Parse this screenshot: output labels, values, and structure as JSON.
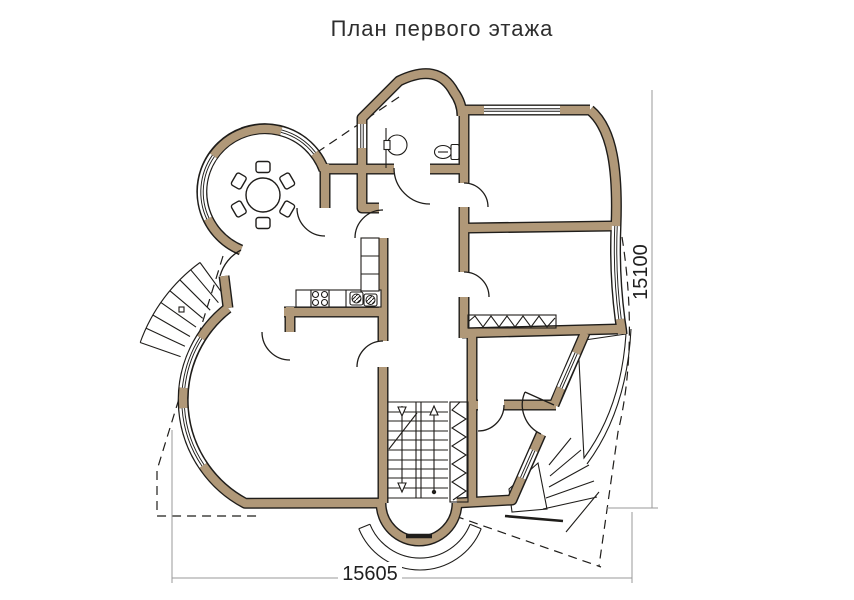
{
  "title": "План первого этажа",
  "dimensions": {
    "height": "15100",
    "width": "15605"
  },
  "colors": {
    "wall": "#b09878",
    "line": "#1f1d1a",
    "dim": "#9a9a9a",
    "text": "#1f1f1f",
    "bg": "#ffffff"
  },
  "features": {
    "dining": [
      "round-table-icon",
      "chair-icon-x6",
      "curved-bay-window"
    ],
    "kitchen": [
      "counter",
      "stove-icon",
      "double-sink-icon"
    ],
    "bathroom": [
      "toilet-icon",
      "washbasin-icon"
    ],
    "circulation": [
      "internal-staircase",
      "entrance-porch-steps",
      "external-curved-stairs",
      "external-fan-steps"
    ],
    "storage": [
      "built-in-wardrobe-hatch-x2"
    ],
    "outdoor": [
      "terrace-dotted-paving",
      "roof-overhang-dashed-outline"
    ]
  }
}
